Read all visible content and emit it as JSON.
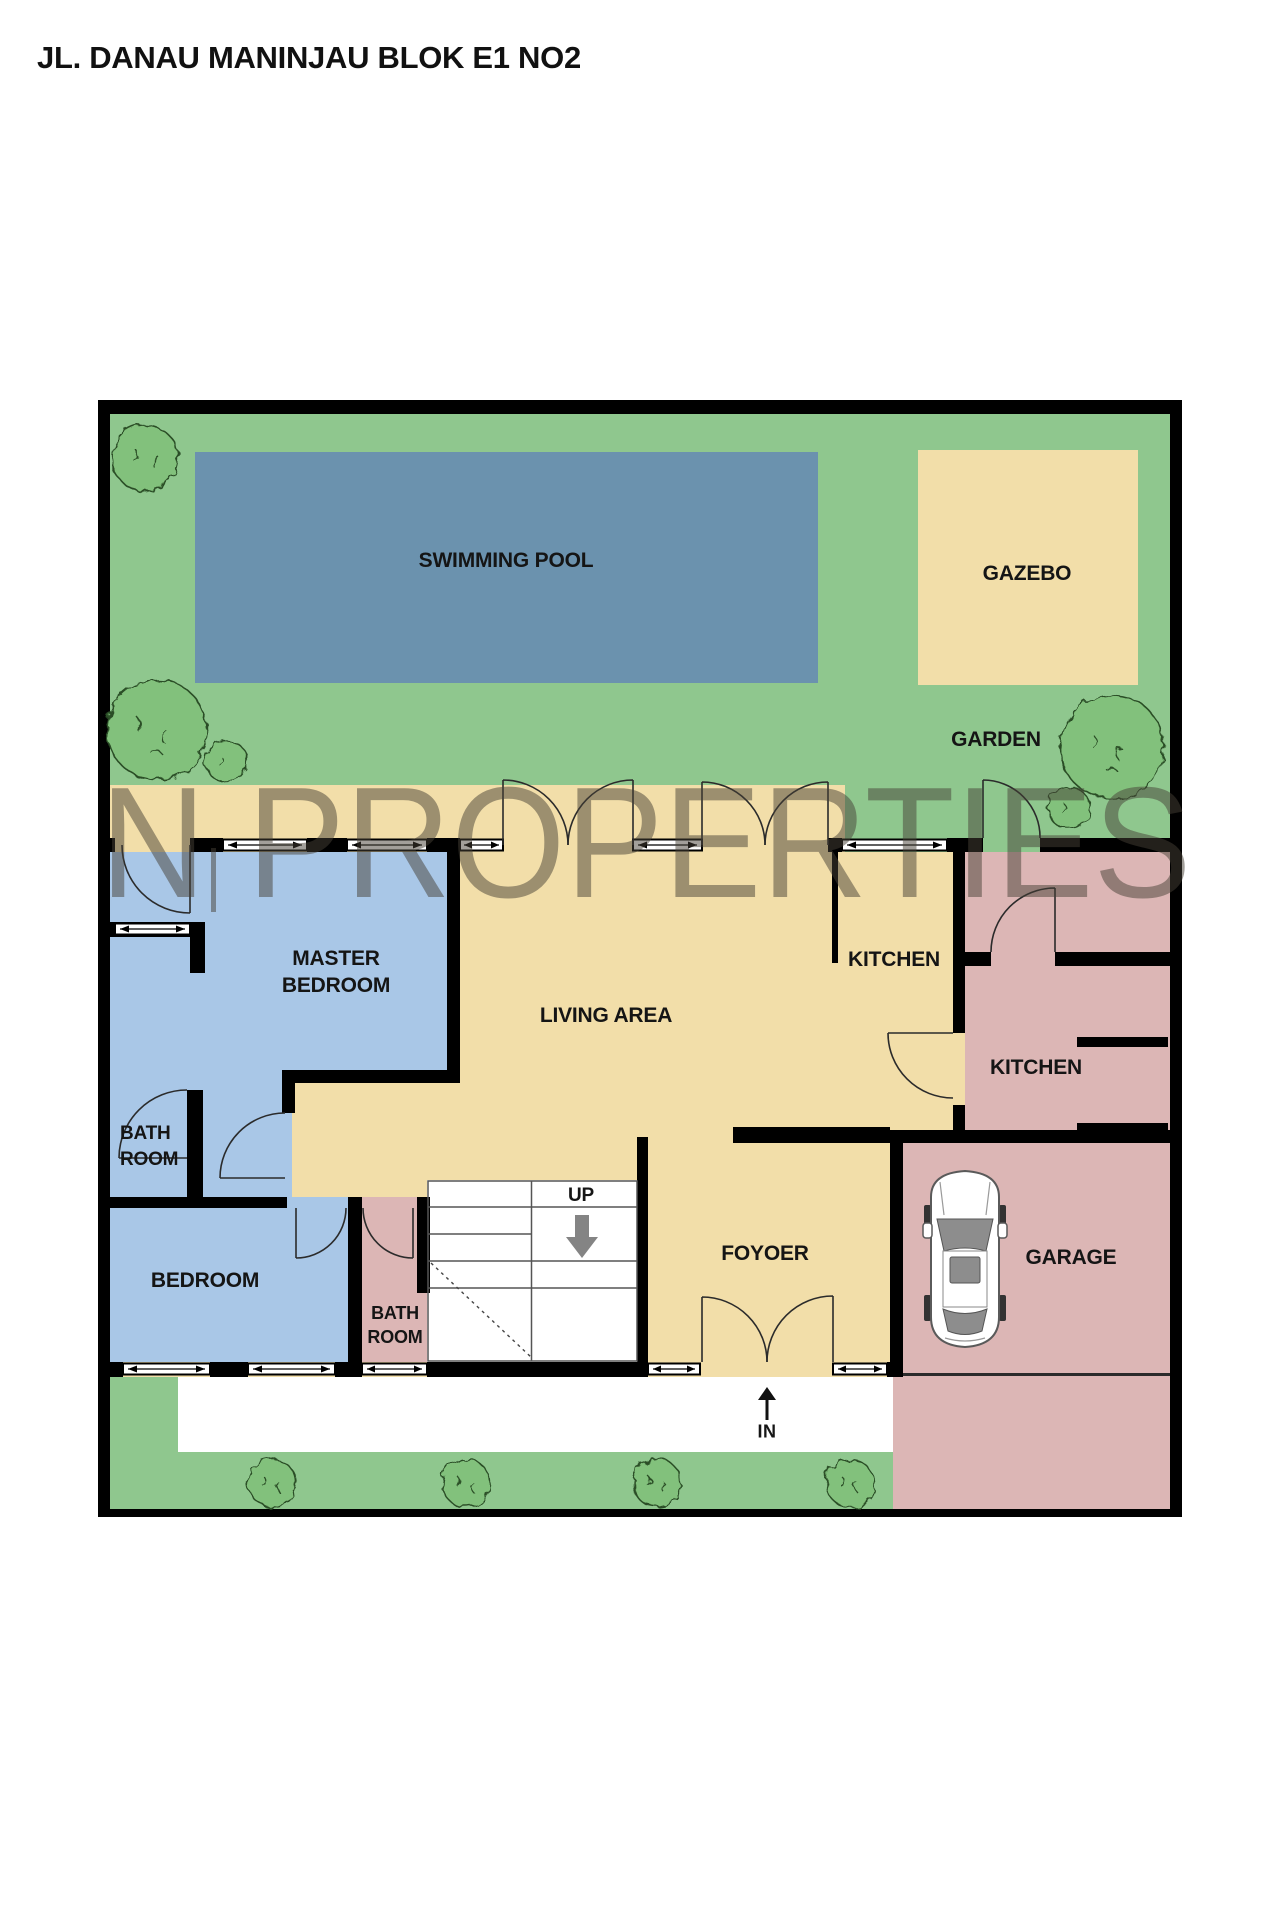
{
  "page_title": "JL. DANAU MANINJAU BLOK E1 NO2",
  "watermark": {
    "text": "N PROPERTIES"
  },
  "labels": {
    "swimming_pool": "SWIMMING POOL",
    "gazebo": "GAZEBO",
    "garden": "GARDEN",
    "master_bedroom": "MASTER BEDROOM",
    "living_area": "LIVING AREA",
    "kitchen_upper": "KITCHEN",
    "kitchen_service": "KITCHEN",
    "bathroom_master": "BATH ROOM",
    "bedroom": "BEDROOM",
    "bathroom_shared": "BATH ROOM",
    "foyer": "FOYOER",
    "garage": "GARAGE",
    "stairs_up": "UP",
    "entrance_in": "IN"
  },
  "colors": {
    "garden": "#8FC78E",
    "pool": "#6B92AE",
    "floor": "#F2DEA9",
    "bedroom_suite": "#A9C7E7",
    "service": "#DCB6B5",
    "wall": "#000000",
    "label_text": "#151515",
    "watermark_gray": "rgba(70,64,54,0.5)"
  }
}
